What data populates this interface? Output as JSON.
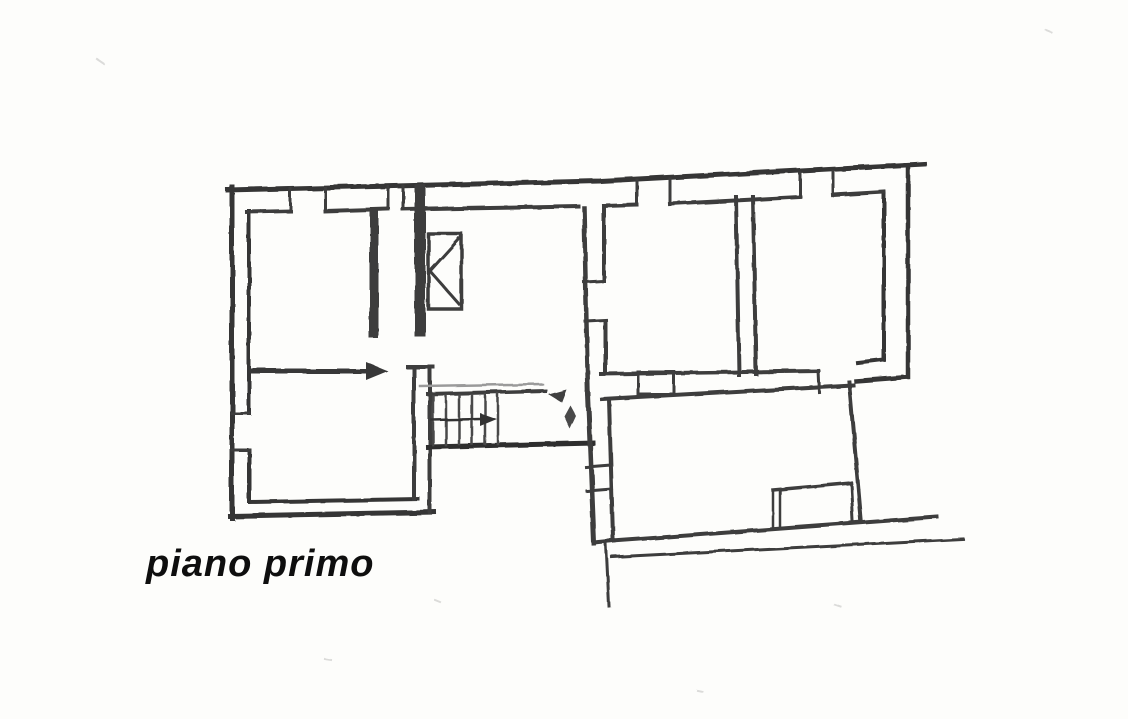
{
  "meta": {
    "document_type": "scanned hand-drawn floor plan",
    "language": "it"
  },
  "palette": {
    "paper": "#fdfdfb",
    "ink": "#3c3c3c",
    "ink_dark": "#2e2e2e",
    "ink_light": "#8f8f8f",
    "caption_color": "#0e0e0e"
  },
  "caption": {
    "label": "piano primo"
  },
  "plan": {
    "floor_label": "piano primo",
    "stairs": {
      "tread_count": 6,
      "direction_arrow": "right"
    },
    "window_openings_count": 6,
    "elements": [
      "exterior-double-walls",
      "interior-partition-walls",
      "staircase-with-direction-arrow",
      "flue-shaft-symbol",
      "window-jamb-openings",
      "door-openings",
      "corridor-threshold",
      "balcony-recess",
      "site-boundary-lines"
    ]
  }
}
